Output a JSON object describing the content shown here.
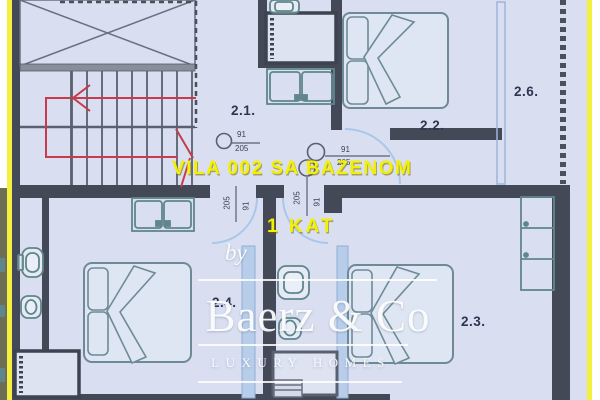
{
  "overlay": {
    "project_title": "VILA 002 SA BAZENOM",
    "floor_label": "1 KAT"
  },
  "watermark": {
    "prefix": "by",
    "brand": "Baerz & Co",
    "tagline": "LUXURY HOMES"
  },
  "rooms": {
    "hall": "2.1.",
    "bedroom_top": "2.2.",
    "bedroom_right": "2.3.",
    "bedroom_left": "2.4.",
    "terrace": "2.6."
  },
  "doors": [
    {
      "w": "91",
      "h": "205"
    },
    {
      "w": "91",
      "h": "205"
    },
    {
      "w": "91",
      "h": "205"
    },
    {
      "w": "91",
      "h": "205"
    }
  ],
  "colors": {
    "plan_background": "#d9dff1",
    "wall": "#434956",
    "frame_yellow": "#f4f13e",
    "title_yellow": "#f3f000",
    "stair_arrow_red": "#c73b4b",
    "fixture_teal": "#5f868c",
    "glass_blue": "#aac6e8",
    "label_navy": "#2d3551"
  }
}
